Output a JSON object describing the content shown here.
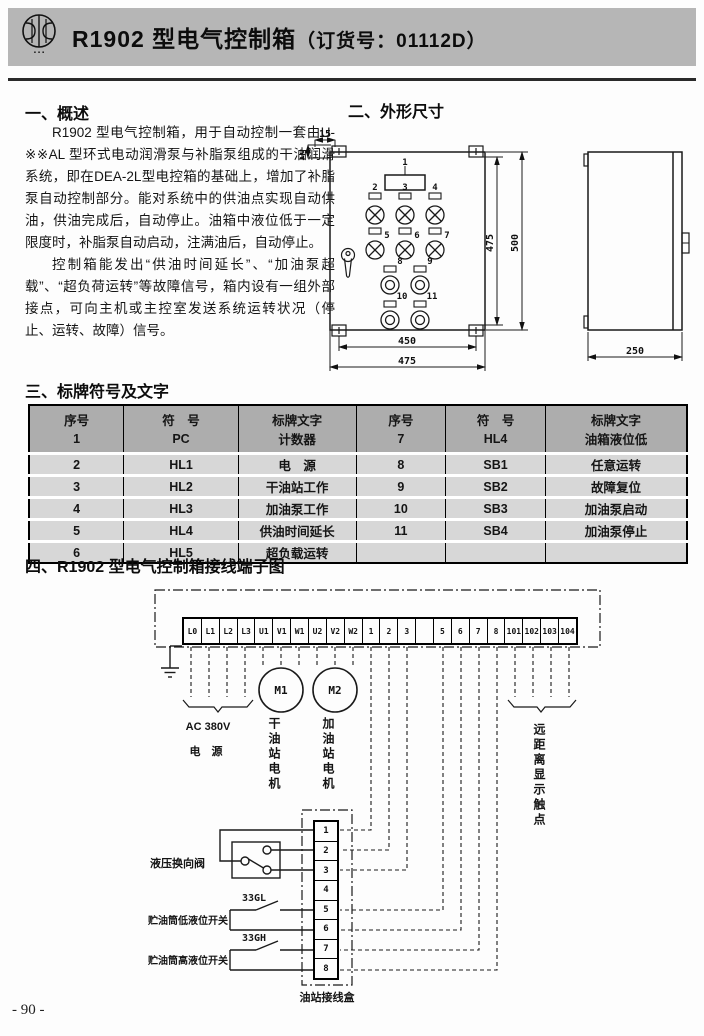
{
  "header": {
    "title_main": "R1902 型电气控制箱",
    "title_sub": "（订货号：01112D）",
    "logo_subtext": "▪▪▪"
  },
  "overview": {
    "heading": "一、概述",
    "para1": "R1902 型电气控制箱，用于自动控制一套由U-※※AL 型环式电动润滑泵与补脂泵组成的干油润滑系统，即在DEA-2L型电控箱的基础上，增加了补脂泵自动控制部分。能对系统中的供油点实现自动供油，供油完成后，自动停止。油箱中液位低于一定限度时，补脂泵自动启动，注满油后，自动停止。",
    "para2": "控制箱能发出“供油时间延长”、“加油泵超载”、“超负荷运转”等故障信号，箱内设有一组外部接点，可向主机或主控室发送系统运转状况（停止、运转、故障）信号。"
  },
  "dimensions": {
    "heading": "二、外形尺寸",
    "front": {
      "dim_top": "15",
      "dim_side": "10",
      "dim_inner_h": "475",
      "dim_outer_h": "500",
      "dim_inner_w": "450",
      "dim_outer_w": "475",
      "panel_items": [
        "1",
        "2",
        "3",
        "4",
        "5",
        "6",
        "7",
        "8",
        "9",
        "10",
        "11"
      ]
    },
    "side": {
      "dim_depth": "250"
    }
  },
  "nameplate": {
    "heading": "三、标牌符号及文字",
    "col_headers": {
      "no": "序号",
      "sym": "符　号",
      "text": "标牌文字"
    },
    "rows_left": [
      {
        "no": "1",
        "sym": "PC",
        "text": "计数器"
      },
      {
        "no": "2",
        "sym": "HL1",
        "text": "电　源"
      },
      {
        "no": "3",
        "sym": "HL2",
        "text": "干油站工作"
      },
      {
        "no": "4",
        "sym": "HL3",
        "text": "加油泵工作"
      },
      {
        "no": "5",
        "sym": "HL4",
        "text": "供油时间延长"
      },
      {
        "no": "6",
        "sym": "HL5",
        "text": "超负载运转"
      }
    ],
    "rows_right": [
      {
        "no": "7",
        "sym": "HL4",
        "text": "油箱液位低"
      },
      {
        "no": "8",
        "sym": "SB1",
        "text": "任意运转"
      },
      {
        "no": "9",
        "sym": "SB2",
        "text": "故障复位"
      },
      {
        "no": "10",
        "sym": "SB3",
        "text": "加油泵启动"
      },
      {
        "no": "11",
        "sym": "SB4",
        "text": "加油泵停止"
      },
      {
        "no": "",
        "sym": "",
        "text": ""
      }
    ]
  },
  "wiring": {
    "heading": "四、R1902 型电气控制箱接线端子图",
    "terminals": [
      "L0",
      "L1",
      "L2",
      "L3",
      "U1",
      "V1",
      "W1",
      "U2",
      "V2",
      "W2",
      "1",
      "2",
      "3",
      "",
      "5",
      "6",
      "7",
      "8",
      "101",
      "102",
      "103",
      "104"
    ],
    "labels": {
      "power_line1": "AC 380V",
      "power_line2": "电 源",
      "m1": "M1",
      "m2": "M2",
      "m1_label": "干油站电机",
      "m2_label": "加油站电机",
      "remote": "远距离显示触点",
      "valve": "液压换向阀",
      "sw_low_tag": "33GL",
      "sw_low": "贮油筒低液位开关",
      "sw_high_tag": "33GH",
      "sw_high": "贮油筒高液位开关",
      "junction_box": "油站接线盒",
      "junction_terminals": [
        "1",
        "2",
        "3",
        "4",
        "5",
        "6",
        "7",
        "8"
      ]
    }
  },
  "footer": {
    "page_number": "- 90 -"
  }
}
